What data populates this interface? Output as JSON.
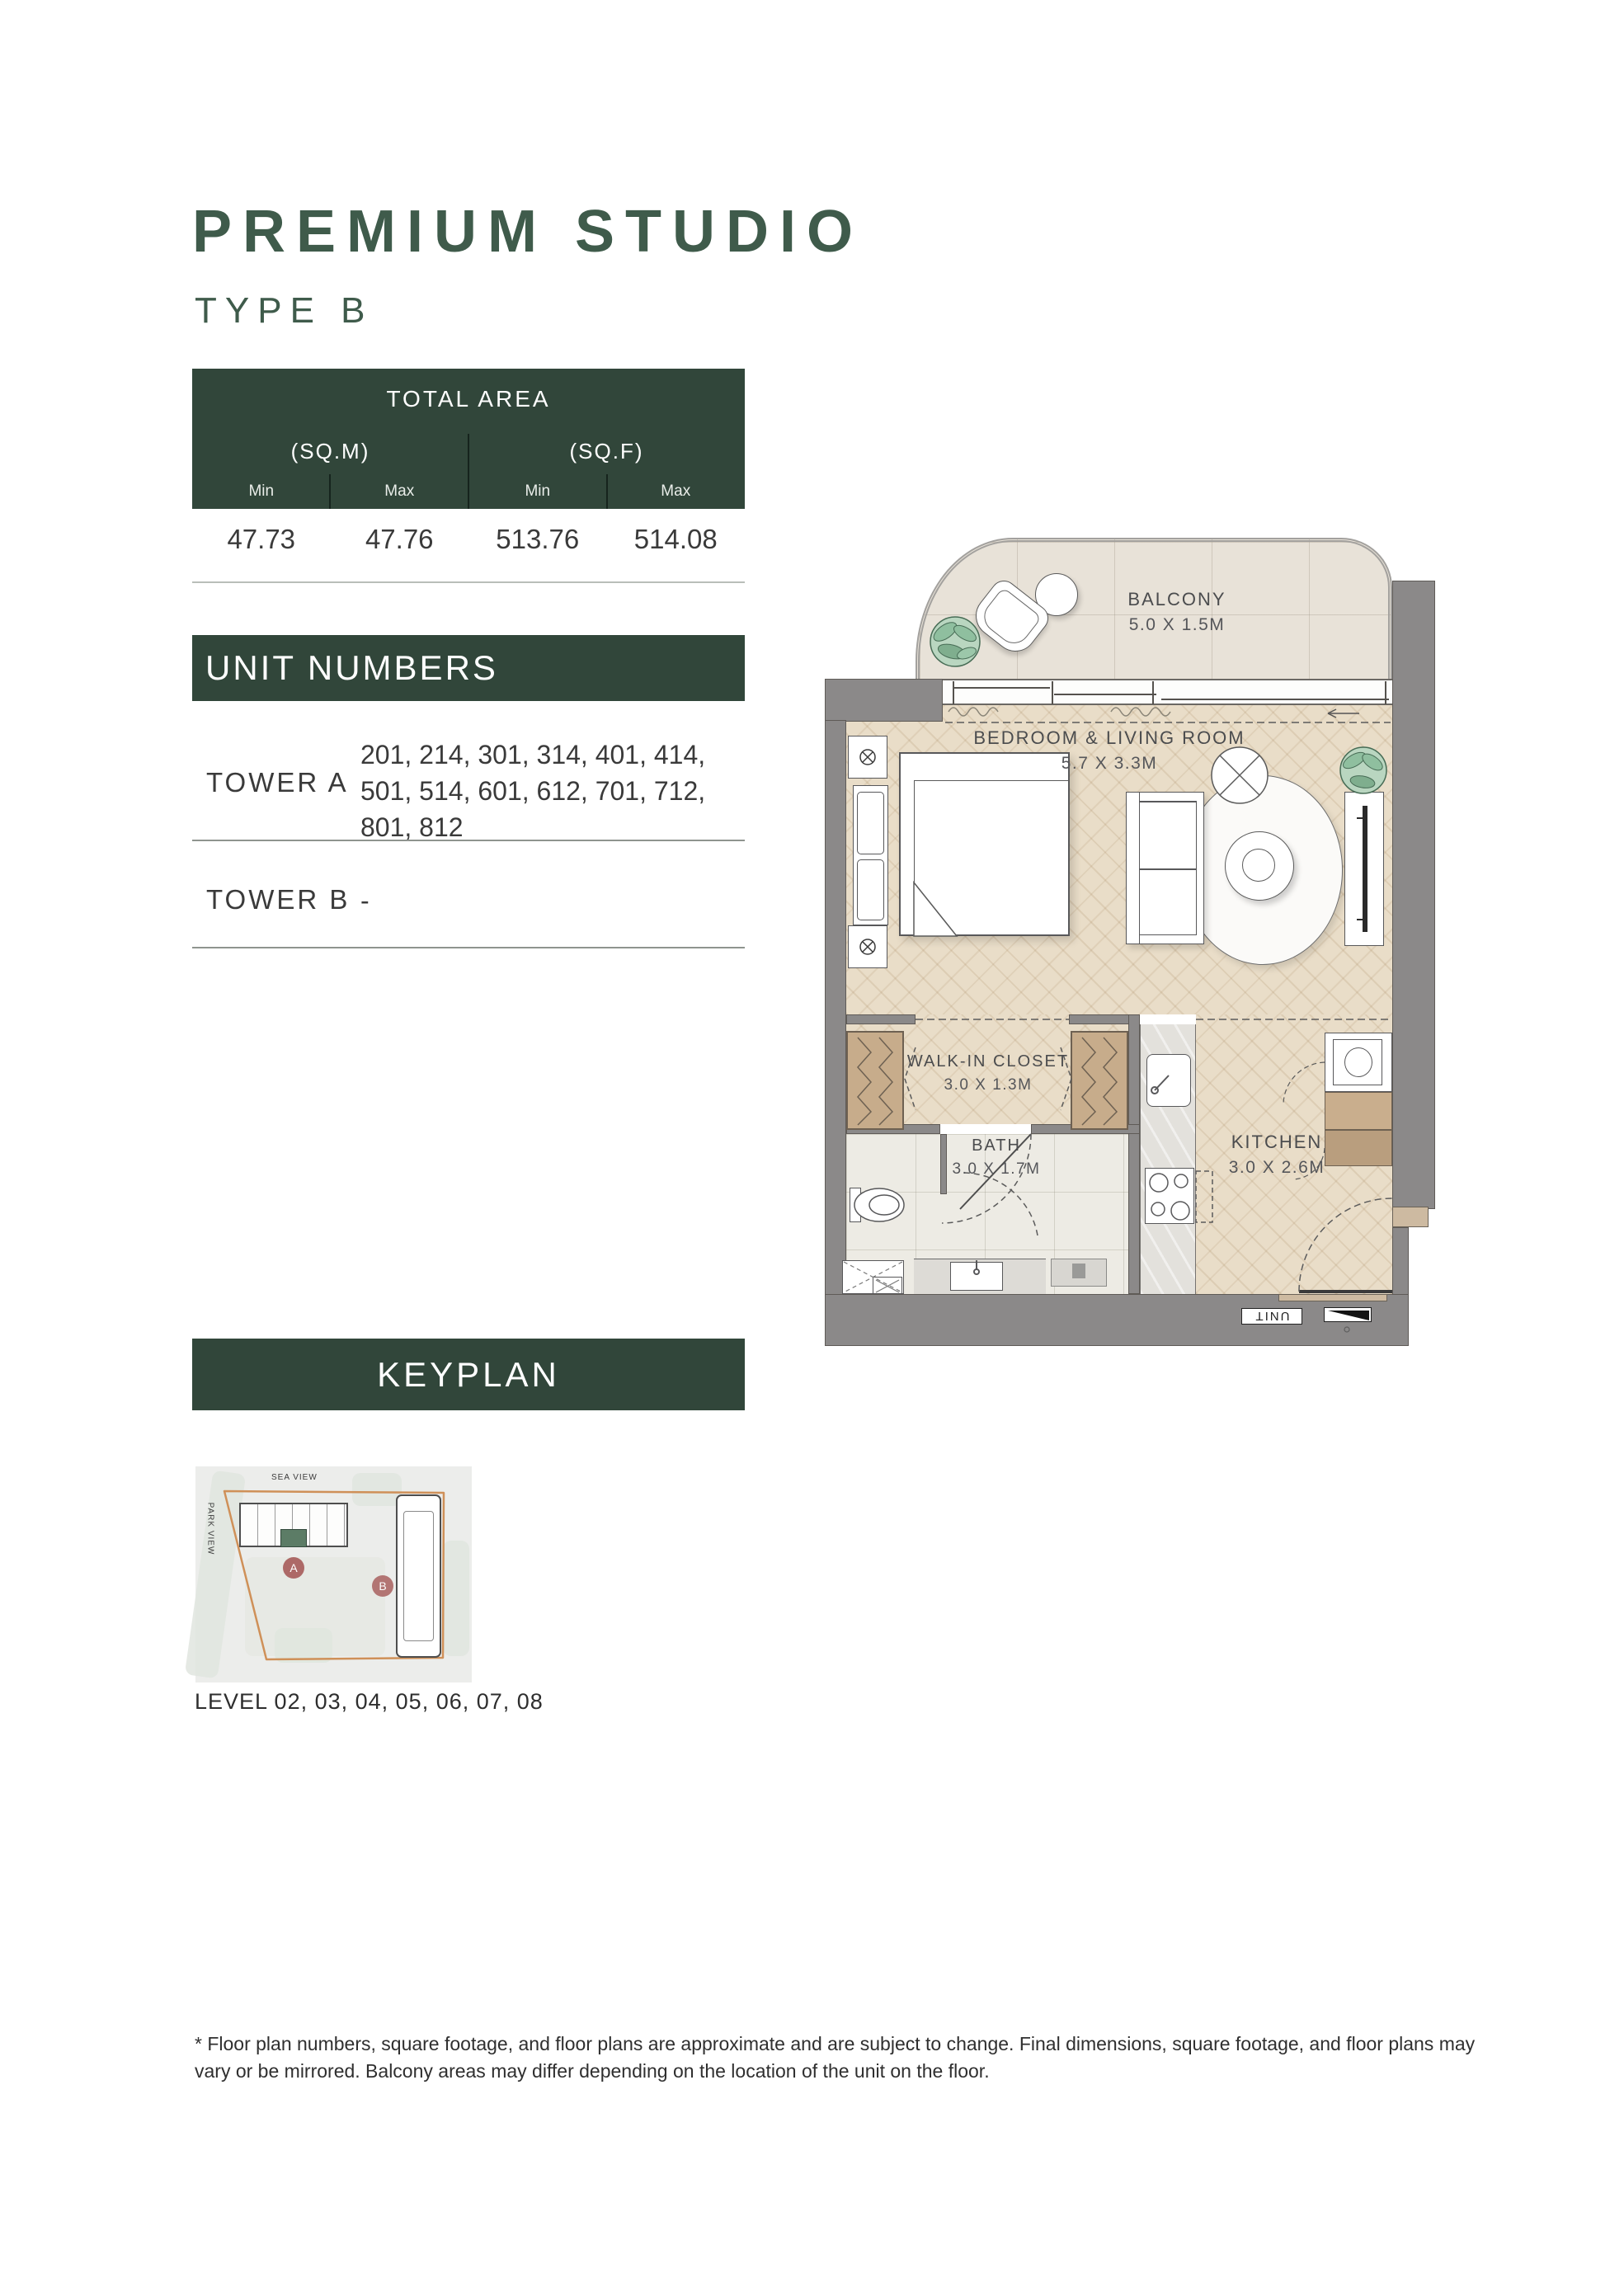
{
  "page": {
    "title": "PREMIUM STUDIO",
    "subtitle": "TYPE B",
    "footnote": "* Floor plan numbers, square footage, and floor plans are approximate and are subject to change. Final dimensions, square footage, and floor plans may vary or be mirrored. Balcony areas may differ depending on the location of the unit on the floor."
  },
  "total_area": {
    "header": "TOTAL AREA",
    "sqm_label": "(SQ.M)",
    "sqf_label": "(SQ.F)",
    "columns": [
      "Min",
      "Max",
      "Min",
      "Max"
    ],
    "values": [
      "47.73",
      "47.76",
      "513.76",
      "514.08"
    ]
  },
  "unit_numbers": {
    "header": "UNIT NUMBERS",
    "rows": [
      {
        "label": "TOWER A",
        "value": "201, 214, 301, 314, 401, 414, 501, 514, 601, 612, 701, 712, 801, 812"
      },
      {
        "label": "TOWER B",
        "value": "-"
      }
    ]
  },
  "keyplan": {
    "header": "KEYPLAN",
    "sea_view": "SEA VIEW",
    "park_view": "PARK VIEW",
    "tower_a_badge": "A",
    "tower_b_badge": "B",
    "level_text": "LEVEL 02, 03, 04, 05, 06, 07, 08"
  },
  "floor_plan": {
    "rooms": [
      {
        "name": "BALCONY",
        "dimensions": "5.0 X 1.5M"
      },
      {
        "name": "BEDROOM & LIVING ROOM",
        "dimensions": "5.7 X 3.3M"
      },
      {
        "name": "WALK-IN CLOSET",
        "dimensions": "3.0 X 1.3M"
      },
      {
        "name": "BATH",
        "dimensions": "3.0 X 1.7M"
      },
      {
        "name": "KITCHEN",
        "dimensions": "3.0 X 2.6M"
      }
    ],
    "unit_marker": "UNIT"
  },
  "colors": {
    "accent_green": "#31463a",
    "title_green": "#3f5b4b",
    "keyplan_orange": "#cf9058",
    "badge_red": "#ad6967",
    "wall_gray": "#8b8989",
    "wood": "#e9ddc8"
  }
}
